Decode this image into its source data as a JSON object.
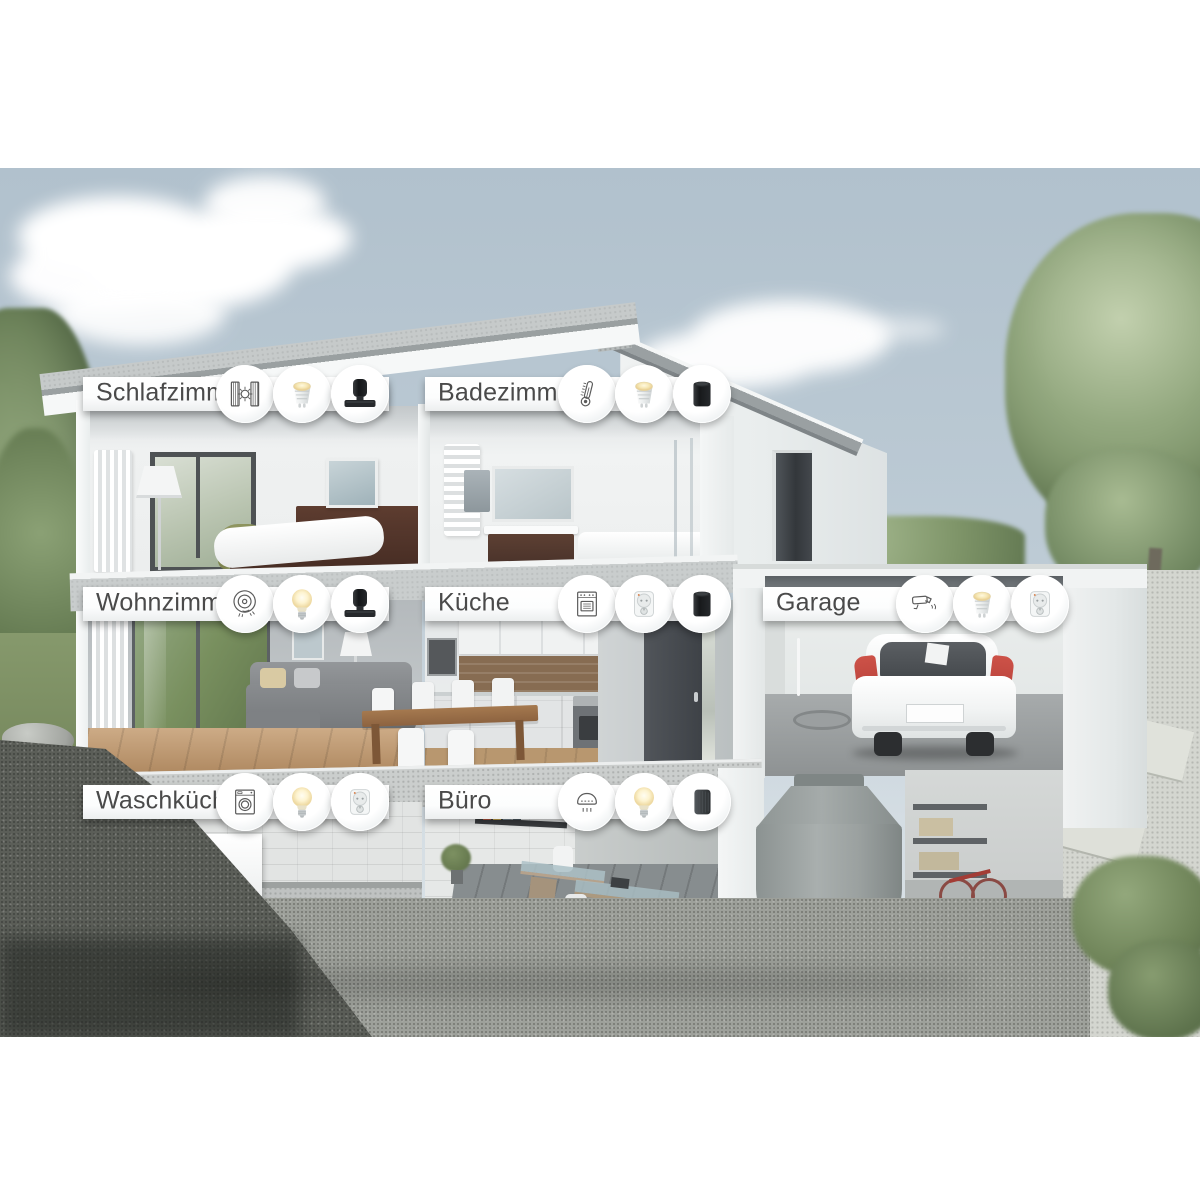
{
  "rooms": [
    {
      "label": "Schlafzimmer",
      "icons": [
        "curtain-sun-icon",
        "gu10-bulb-icon",
        "speaker-soundbar-icon"
      ]
    },
    {
      "label": "Badezimmer",
      "icons": [
        "thermometer-icon",
        "gu10-bulb-icon",
        "black-speaker-icon"
      ]
    },
    {
      "label": "Wohnzimmer",
      "icons": [
        "robot-vacuum-icon",
        "e27-bulb-icon",
        "speaker-soundbar-icon"
      ]
    },
    {
      "label": "Küche",
      "icons": [
        "oven-icon",
        "smart-plug-icon",
        "black-speaker-icon"
      ]
    },
    {
      "label": "Garage",
      "icons": [
        "security-camera-icon",
        "gu10-bulb-icon",
        "smart-plug-icon"
      ]
    },
    {
      "label": "Waschküche",
      "icons": [
        "washing-machine-icon",
        "e27-bulb-icon",
        "smart-plug-icon"
      ]
    },
    {
      "label": "Büro",
      "icons": [
        "smoke-detector-icon",
        "e27-bulb-icon",
        "fabric-speaker-icon"
      ]
    }
  ],
  "palette": {
    "banner_text": "#4a4a4a",
    "banner_bg": "#ffffff",
    "sky_top": "#b1c1cd",
    "sky_bottom": "#d4dde3",
    "foliage_green": "#879c72",
    "house_white": "#f2f4f4",
    "concrete_gray": "#c7cbca",
    "car_accent_red": "#c2473f",
    "device_black": "#1d2022",
    "bulb_warm": "#f6e7b4"
  }
}
